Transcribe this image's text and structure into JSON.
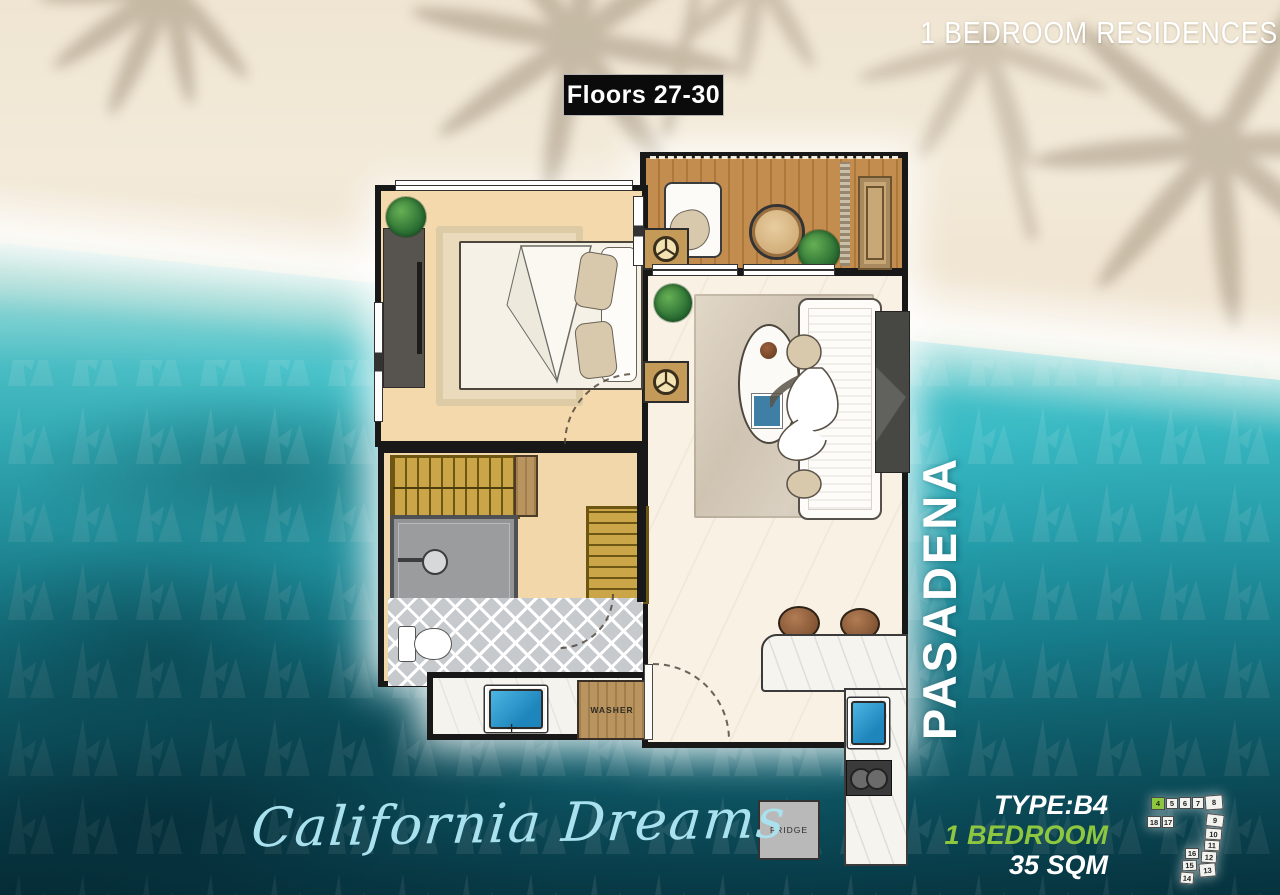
{
  "scene": {
    "header_title": "1 BEDROOM RESIDENCES",
    "floors_badge": "Floors 27-30"
  },
  "branding": {
    "building_name": "PASADENA",
    "tagline": "California Dreams"
  },
  "unit_info": {
    "type": "TYPE:B4",
    "bedrooms": "1 BEDROOM",
    "area": "35 SQM"
  },
  "floorplan_labels": {
    "fridge": "FRIDGE",
    "washer": "WASHER"
  },
  "keyplan": {
    "highlighted_unit": "4",
    "units": [
      "4",
      "5",
      "6",
      "7",
      "8",
      "18",
      "17",
      "9",
      "10",
      "11",
      "16",
      "12",
      "15",
      "13",
      "14"
    ]
  },
  "colors": {
    "accent_green": "#8dc63f",
    "water_teal": "#2fb0be",
    "script_cyan": "#a9e2ee",
    "badge_black": "#0b0b0b",
    "sand": "#efe5d2"
  }
}
